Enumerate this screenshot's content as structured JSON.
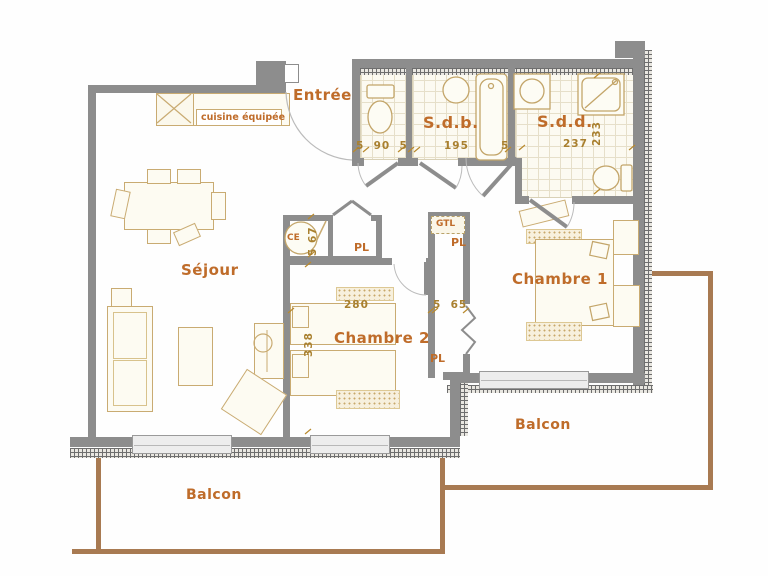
{
  "rooms": {
    "entree": "Entrée",
    "sdb": "S.d.b.",
    "sdd": "S.d.d.",
    "sejour": "Séjour",
    "chambre1": "Chambre 1",
    "chambre2": "Chambre 2",
    "balcon_bottom": "Balcon",
    "balcon_right": "Balcon",
    "cuisine": "cuisine équipée"
  },
  "closets": {
    "ce": "CE",
    "pl_hall": "PL",
    "pl_gtl": "PL",
    "pl_lower": "PL",
    "gtl": "GTL"
  },
  "dims": {
    "wc_width": "5  90  5",
    "sdb_width": "195",
    "sdb_right": "5",
    "sdd_width": "237",
    "sdd_height": "233",
    "ch2_width": "280",
    "ch2_height": "338",
    "pl_width": "5  65",
    "ce_height": "5 67"
  },
  "colors": {
    "wall": "#8d8d8d",
    "label": "#bf6c2a",
    "dimension": "#a9802f",
    "furniture_line": "#c9ab72",
    "railing": "#a87a52"
  }
}
